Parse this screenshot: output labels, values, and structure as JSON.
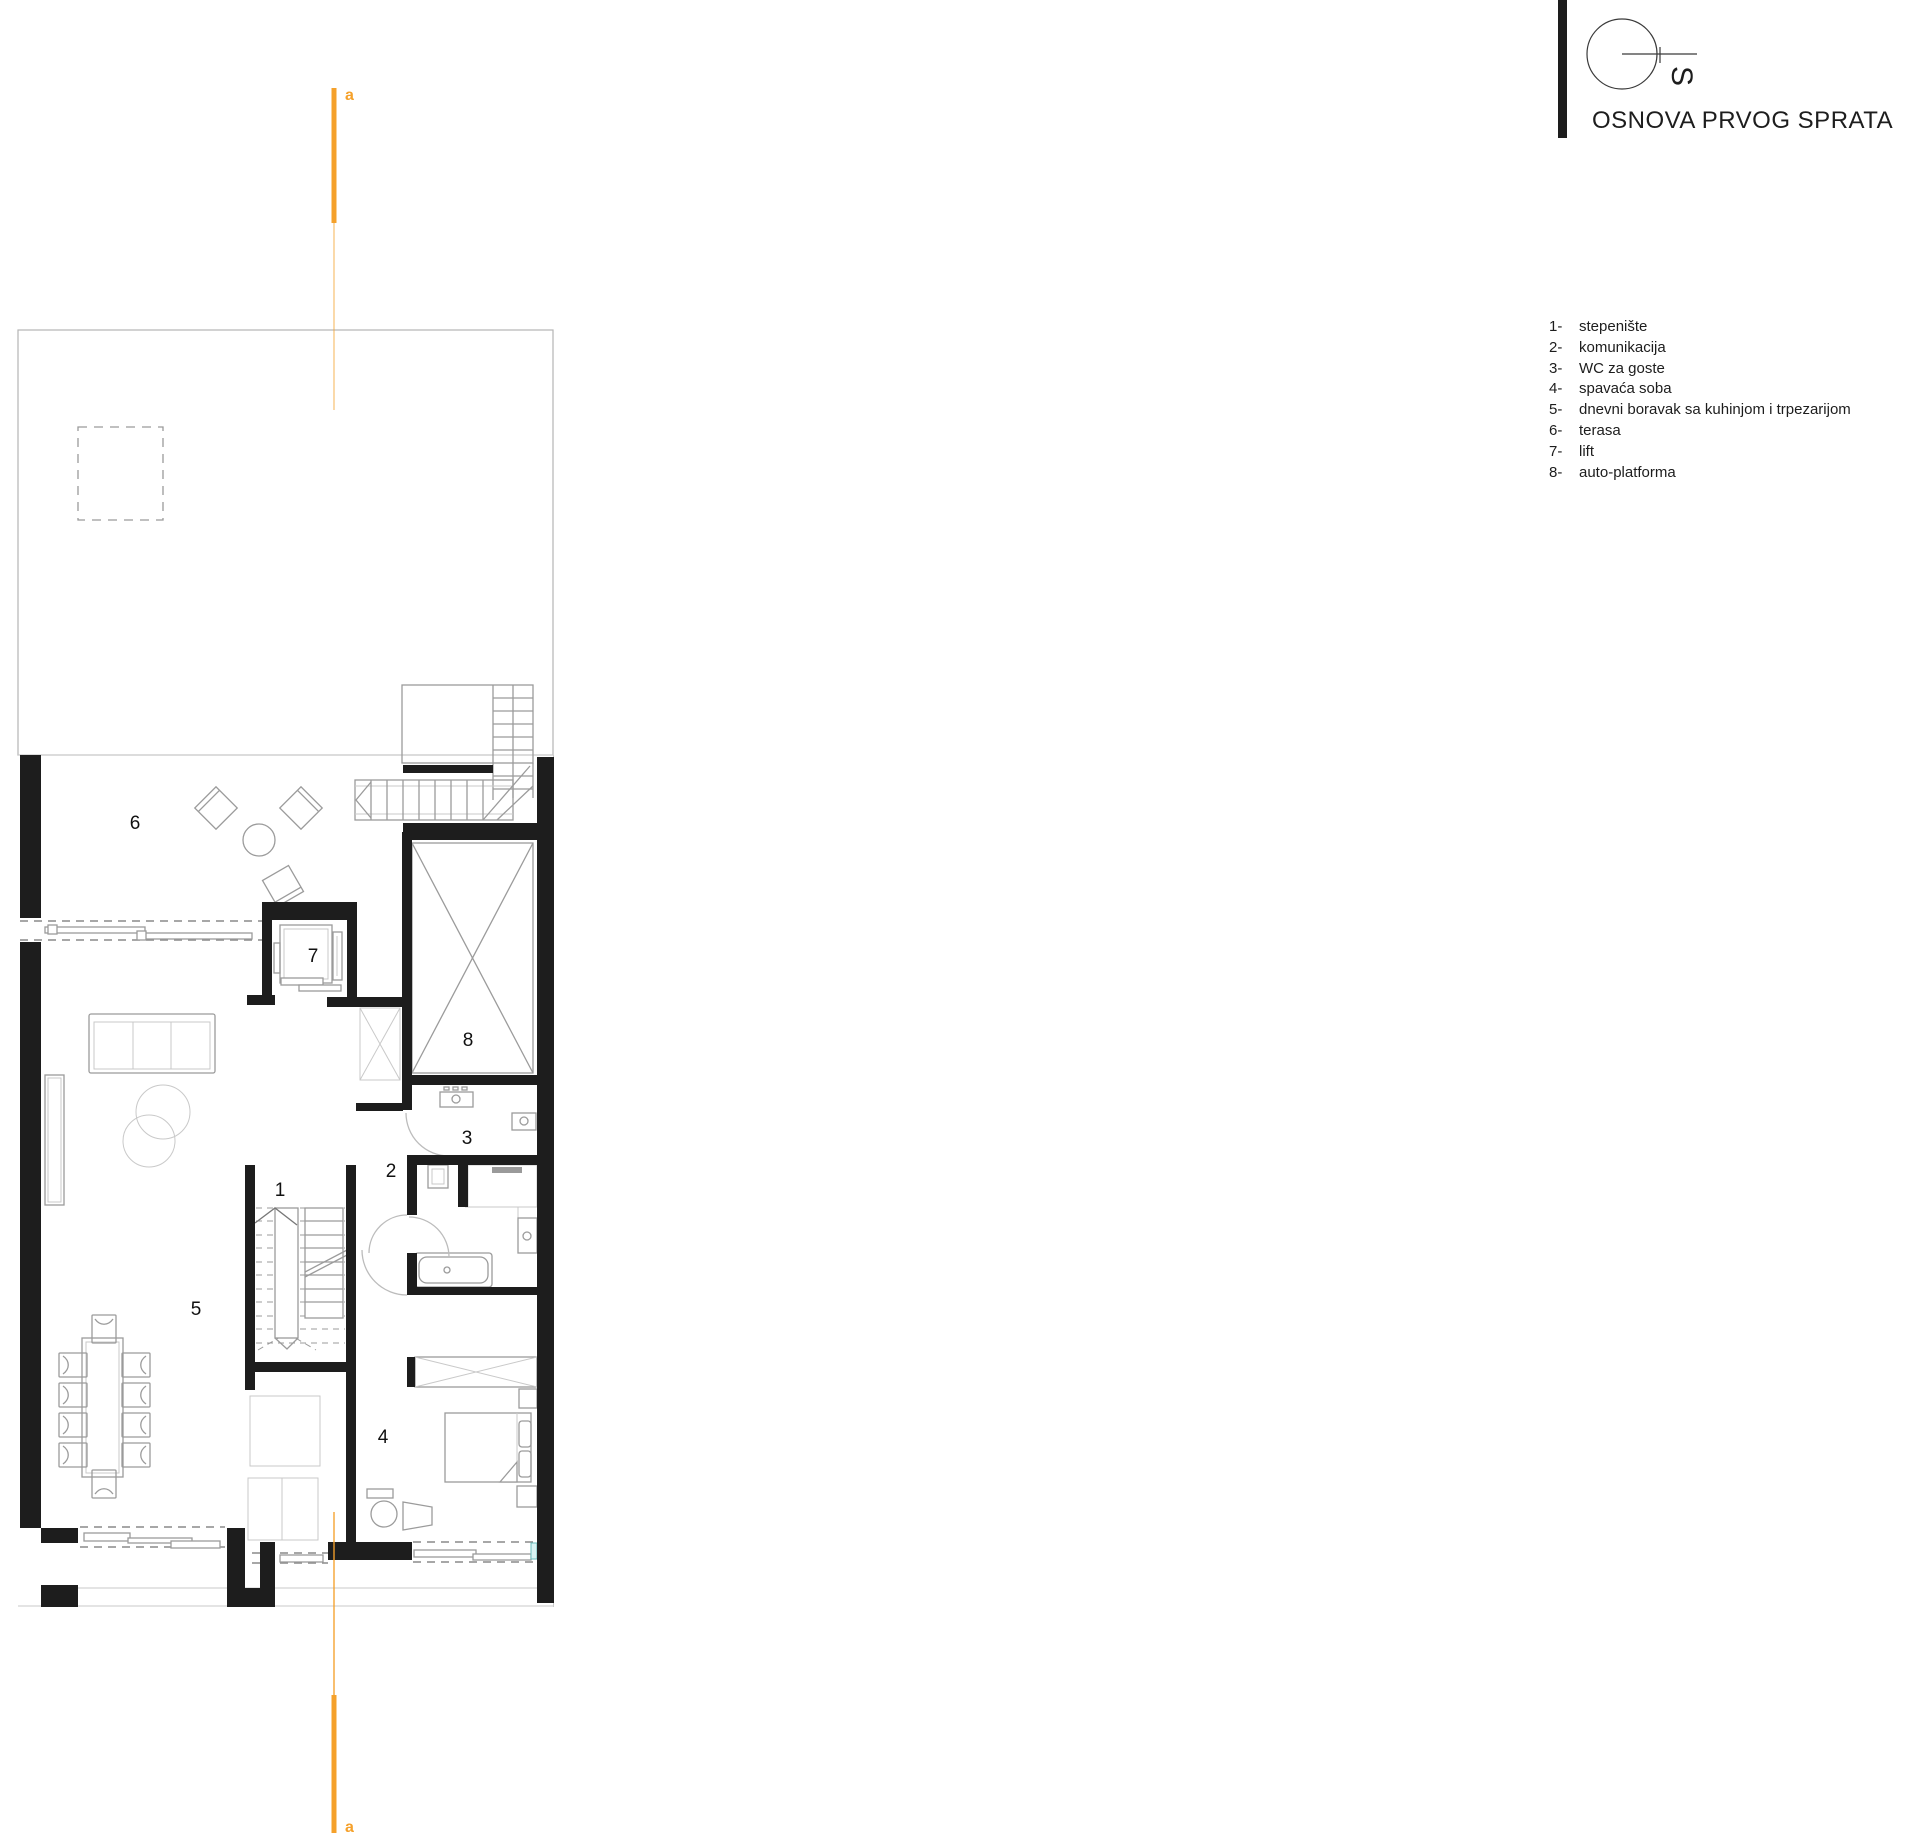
{
  "title": "OSNOVA PRVOG SPRATA",
  "logo": {
    "letter": "S"
  },
  "legend": {
    "items": [
      {
        "num": "1-",
        "label": "stepenište"
      },
      {
        "num": "2-",
        "label": "komunikacija"
      },
      {
        "num": "3-",
        "label": "WC za goste"
      },
      {
        "num": "4-",
        "label": "spavaća soba"
      },
      {
        "num": "5-",
        "label": "dnevni boravak sa kuhinjom i trpezarijom"
      },
      {
        "num": "6-",
        "label": "terasa"
      },
      {
        "num": "7-",
        "label": "lift"
      },
      {
        "num": "8-",
        "label": "auto-platforma"
      }
    ]
  },
  "plan": {
    "rooms": [
      {
        "num": "1"
      },
      {
        "num": "2"
      },
      {
        "num": "3"
      },
      {
        "num": "4"
      },
      {
        "num": "5"
      },
      {
        "num": "6"
      },
      {
        "num": "7"
      },
      {
        "num": "8"
      }
    ]
  },
  "section": {
    "label": "a"
  },
  "colors": {
    "accent_orange": "#F5A12B",
    "wall_black": "#1D1D1D",
    "furniture_line": "#9B9B9B",
    "faint_line": "#C9C9C9",
    "glass_teal": "#69BDBD"
  }
}
